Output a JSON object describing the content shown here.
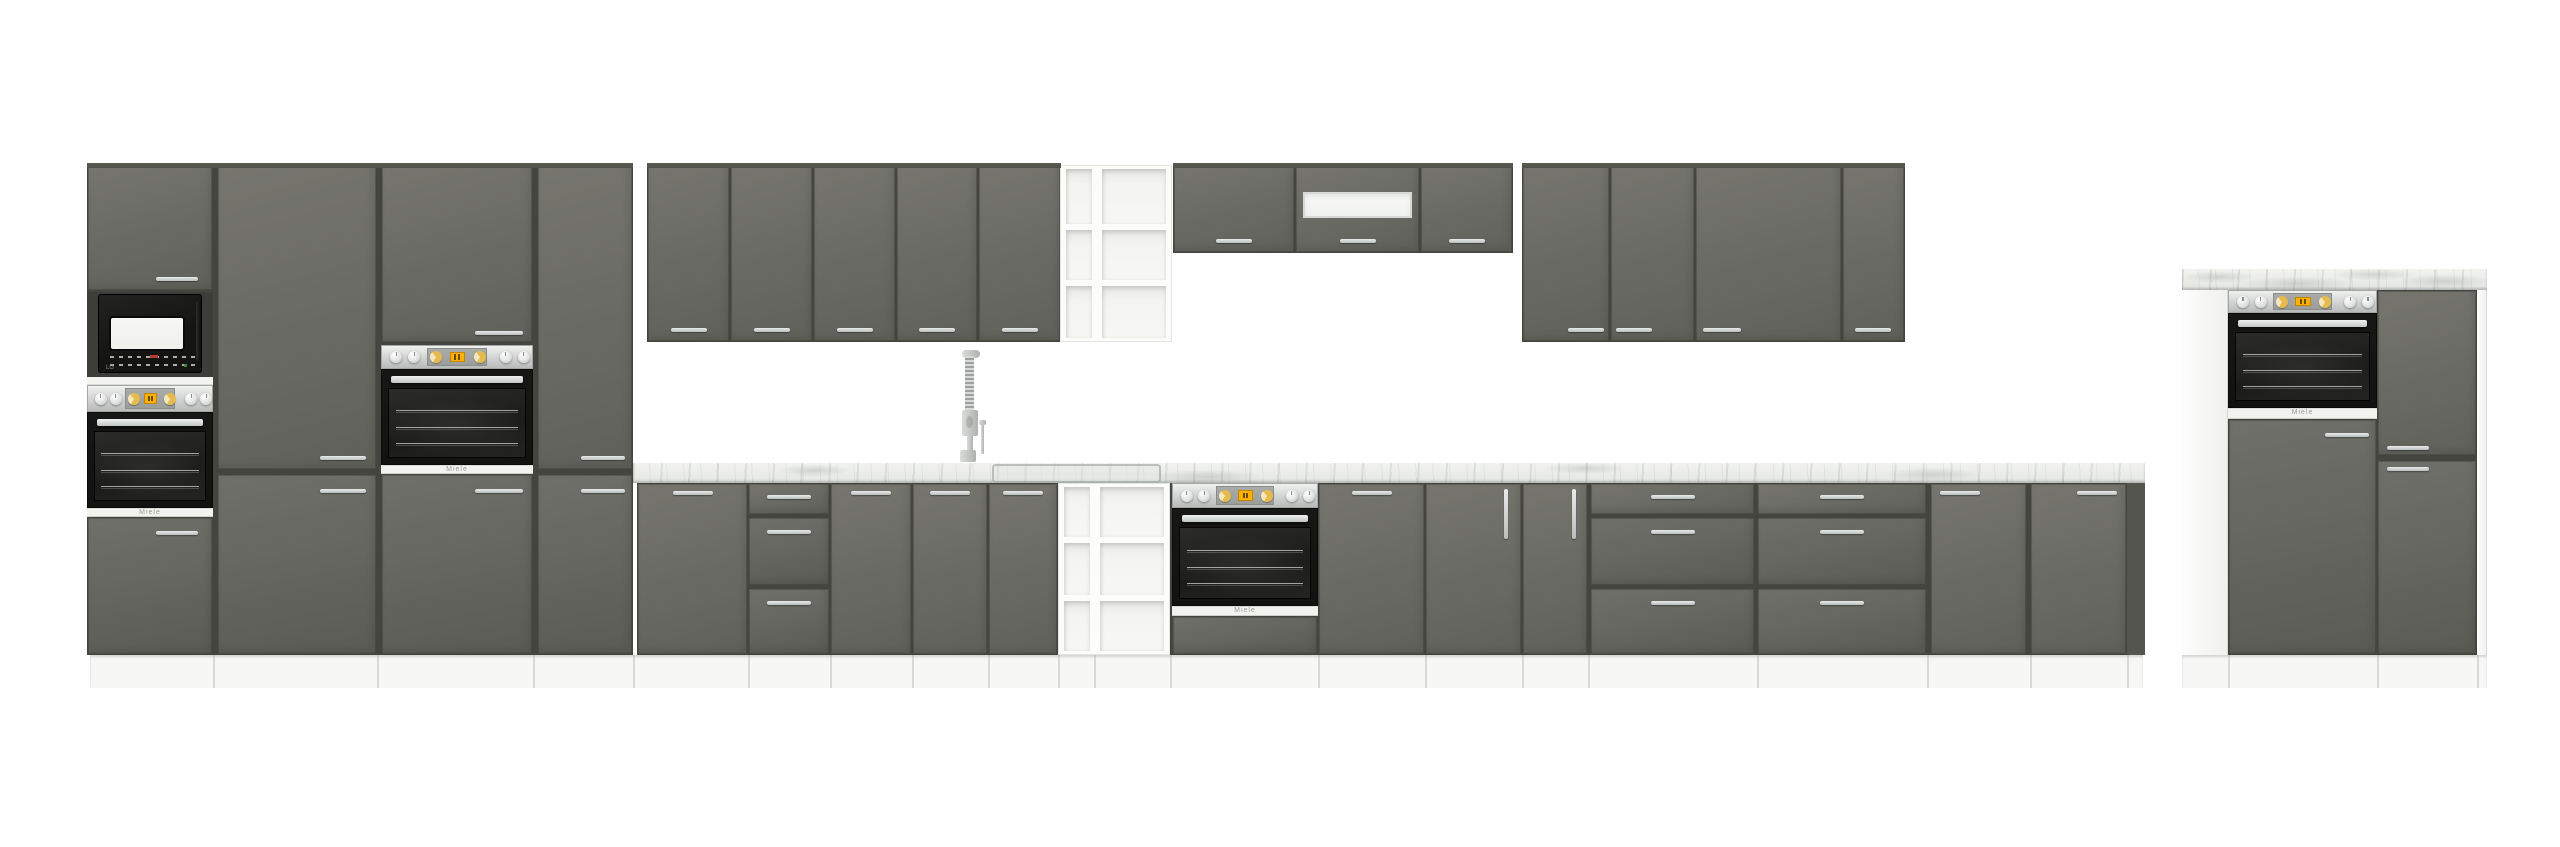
{
  "meta": {
    "description": "Product render of a grey gloss kitchen furniture set on white background",
    "canvas_width": 2560,
    "canvas_height": 847
  },
  "palette": {
    "cabinet_grey": "#6c6c66",
    "cabinet_grey_dark": "#5b5b56",
    "carcass_dark": "#45453f",
    "handle_silver": "#c9cdcc",
    "worktop_marble": "#e9ebe7",
    "appliance_black": "#141413",
    "panel_silver": "#d9dcda",
    "knob_gold": "#e5ba4e",
    "display_amber": "#ffb103",
    "white": "#ffffff"
  },
  "branding": {
    "oven_logo": "Miele",
    "microwave_logo": "LG"
  },
  "scene": {
    "units": [
      {
        "t": "backing",
        "n": "tall-cabinet-group-carcass",
        "x": 87,
        "y": 163,
        "w": 546,
        "h": 492
      },
      {
        "t": "backing",
        "n": "wall-cabinet-run-a-carcass",
        "x": 647,
        "y": 163,
        "w": 414,
        "h": 179
      },
      {
        "t": "backing",
        "n": "wall-cabinet-run-b-carcass",
        "x": 1173,
        "y": 163,
        "w": 340,
        "h": 90
      },
      {
        "t": "backing",
        "n": "wall-cabinet-run-c-carcass",
        "x": 1522,
        "y": 163,
        "w": 383,
        "h": 179
      },
      {
        "t": "backing",
        "n": "base-run-carcass",
        "x": 637,
        "y": 483,
        "w": 1508,
        "h": 172
      },
      {
        "t": "backing",
        "n": "right-group-carcass",
        "x": 2228,
        "y": 290,
        "w": 249,
        "h": 365
      },
      {
        "t": "door",
        "n": "tall-unit-top-door",
        "x": 87,
        "y": 163,
        "w": 126,
        "h": 128,
        "hx": 156,
        "hy": 277,
        "hw": 42
      },
      {
        "t": "micro",
        "n": "built-in-microwave",
        "x": 87,
        "y": 292,
        "w": 126,
        "h": 85
      },
      {
        "t": "whitestrip",
        "n": "shelf-strip",
        "x": 87,
        "y": 377,
        "w": 126,
        "h": 8
      },
      {
        "t": "opanel",
        "n": "oven-control-panel",
        "x": 87,
        "y": 385,
        "w": 126,
        "h": 27
      },
      {
        "t": "oven",
        "n": "built-in-oven",
        "x": 87,
        "y": 412,
        "w": 126,
        "h": 96
      },
      {
        "t": "logostrip",
        "n": "oven-logo-strip",
        "x": 87,
        "y": 508,
        "w": 126,
        "h": 9,
        "label": "oven_logo"
      },
      {
        "t": "door",
        "n": "tall-unit-bottom-door",
        "x": 87,
        "y": 517,
        "w": 126,
        "h": 138,
        "hx": 156,
        "hy": 531,
        "hw": 42,
        "dk": 1
      },
      {
        "t": "door",
        "n": "pantry-tall-door",
        "x": 217,
        "y": 163,
        "w": 160,
        "h": 307,
        "hx": 320,
        "hy": 456,
        "hw": 46
      },
      {
        "t": "door",
        "n": "pantry-bottom-door",
        "x": 217,
        "y": 474,
        "w": 160,
        "h": 181,
        "hx": 320,
        "hy": 489,
        "hw": 46,
        "dk": 1
      },
      {
        "t": "door",
        "n": "oven-tower-top-door",
        "x": 381,
        "y": 163,
        "w": 152,
        "h": 180,
        "hx": 475,
        "hy": 331,
        "hw": 48
      },
      {
        "t": "opanel",
        "n": "oven-control-panel",
        "x": 381,
        "y": 345,
        "w": 152,
        "h": 24
      },
      {
        "t": "oven",
        "n": "built-in-oven",
        "x": 381,
        "y": 369,
        "w": 152,
        "h": 96
      },
      {
        "t": "logostrip",
        "n": "oven-logo-strip",
        "x": 381,
        "y": 465,
        "w": 152,
        "h": 9,
        "label": "oven_logo"
      },
      {
        "t": "door",
        "n": "oven-tower-bottom-door",
        "x": 381,
        "y": 474,
        "w": 152,
        "h": 181,
        "hx": 475,
        "hy": 489,
        "hw": 48,
        "dk": 1
      },
      {
        "t": "door",
        "n": "tall-unit-door",
        "x": 537,
        "y": 163,
        "w": 96,
        "h": 307,
        "hx": 581,
        "hy": 456,
        "hw": 44
      },
      {
        "t": "door",
        "n": "tall-unit-bottom-door",
        "x": 537,
        "y": 474,
        "w": 96,
        "h": 181,
        "hx": 581,
        "hy": 489,
        "hw": 44,
        "dk": 1
      },
      {
        "t": "door",
        "n": "wall-cabinet-door",
        "x": 647,
        "y": 163,
        "w": 83,
        "h": 179,
        "hc": 1,
        "hy": 328,
        "hw": 36
      },
      {
        "t": "door",
        "n": "wall-cabinet-door",
        "x": 730,
        "y": 163,
        "w": 83,
        "h": 179,
        "hc": 1,
        "hy": 328,
        "hw": 36
      },
      {
        "t": "door",
        "n": "wall-cabinet-door",
        "x": 813,
        "y": 163,
        "w": 83,
        "h": 179,
        "hc": 1,
        "hy": 328,
        "hw": 36
      },
      {
        "t": "door",
        "n": "wall-cabinet-door",
        "x": 896,
        "y": 163,
        "w": 82,
        "h": 179,
        "hc": 1,
        "hy": 328,
        "hw": 36
      },
      {
        "t": "door",
        "n": "wall-cabinet-door",
        "x": 978,
        "y": 163,
        "w": 83,
        "h": 179,
        "hc": 1,
        "hy": 328,
        "hw": 36
      },
      {
        "t": "shelf",
        "n": "open-shelf-wall-unit",
        "x": 1060,
        "y": 165,
        "w": 112,
        "h": 177,
        "cols": [
          [
            1066,
            26
          ],
          [
            1102,
            64
          ]
        ],
        "rowsplits": [
          227,
          283
        ]
      },
      {
        "t": "door",
        "n": "wall-cabinet-door",
        "x": 1173,
        "y": 163,
        "w": 122,
        "h": 90,
        "hc": 1,
        "hy": 239,
        "hw": 36
      },
      {
        "t": "door",
        "n": "hood-cabinet-door",
        "x": 1295,
        "y": 163,
        "w": 125,
        "h": 90,
        "hc": 1,
        "hy": 239,
        "hw": 36,
        "glass": [
          1303,
          192,
          109,
          26
        ]
      },
      {
        "t": "door",
        "n": "wall-cabinet-door",
        "x": 1420,
        "y": 163,
        "w": 93,
        "h": 90,
        "hc": 1,
        "hy": 239,
        "hw": 36
      },
      {
        "t": "door",
        "n": "wall-cabinet-door",
        "x": 1522,
        "y": 163,
        "w": 88,
        "h": 179,
        "hx": 1568,
        "hy": 328,
        "hw": 36
      },
      {
        "t": "door",
        "n": "wall-cabinet-door",
        "x": 1610,
        "y": 163,
        "w": 85,
        "h": 179,
        "hx": 1616,
        "hy": 328,
        "hw": 36
      },
      {
        "t": "door",
        "n": "wall-cabinet-door",
        "x": 1695,
        "y": 163,
        "w": 147,
        "h": 179,
        "hx": 1703,
        "hy": 328,
        "hw": 38
      },
      {
        "t": "door",
        "n": "wall-cabinet-door",
        "x": 1842,
        "y": 163,
        "w": 63,
        "h": 179,
        "hx": 1855,
        "hy": 328,
        "hw": 36
      },
      {
        "t": "marble",
        "n": "worktop",
        "x": 633,
        "y": 462,
        "w": 1512,
        "h": 21
      },
      {
        "t": "door",
        "n": "base-cabinet-door",
        "x": 637,
        "y": 483,
        "w": 111,
        "h": 172,
        "hc": 1,
        "hy": 491,
        "hw": 40
      },
      {
        "t": "drawers",
        "n": "drawer-unit",
        "x": 748,
        "y": 483,
        "w": 82,
        "hw": 44
      },
      {
        "t": "door",
        "n": "base-cabinet-door",
        "x": 830,
        "y": 483,
        "w": 82,
        "h": 172,
        "hc": 1,
        "hy": 491,
        "hw": 40
      },
      {
        "t": "door",
        "n": "base-cabinet-door",
        "x": 912,
        "y": 483,
        "w": 76,
        "h": 172,
        "hc": 1,
        "hy": 491,
        "hw": 40
      },
      {
        "t": "door",
        "n": "base-cabinet-door",
        "x": 988,
        "y": 483,
        "w": 70,
        "h": 172,
        "hc": 1,
        "hy": 491,
        "hw": 40
      },
      {
        "t": "shelf",
        "n": "open-shelf-base-unit",
        "x": 1058,
        "y": 483,
        "w": 112,
        "h": 172,
        "cols": [
          [
            1064,
            26
          ],
          [
            1100,
            64
          ]
        ],
        "rowsplits": [
          540,
          598
        ]
      },
      {
        "t": "opanel",
        "n": "oven-control-panel",
        "x": 1172,
        "y": 483,
        "w": 146,
        "h": 25
      },
      {
        "t": "oven",
        "n": "built-in-oven",
        "x": 1172,
        "y": 508,
        "w": 146,
        "h": 98
      },
      {
        "t": "logostrip",
        "n": "oven-logo-strip",
        "x": 1172,
        "y": 606,
        "w": 146,
        "h": 10,
        "label": "oven_logo"
      },
      {
        "t": "door",
        "n": "oven-base-filler-panel",
        "x": 1172,
        "y": 616,
        "w": 146,
        "h": 39,
        "dk": 1
      },
      {
        "t": "door",
        "n": "base-cabinet-door",
        "x": 1318,
        "y": 483,
        "w": 107,
        "h": 172,
        "hc": 1,
        "hy": 491,
        "hw": 40
      },
      {
        "t": "door",
        "n": "base-cabinet-door",
        "x": 1425,
        "y": 483,
        "w": 97,
        "h": 172,
        "hv": 1,
        "hx": 1504,
        "hy": 489,
        "hh": 50
      },
      {
        "t": "door",
        "n": "base-cabinet-door",
        "x": 1522,
        "y": 483,
        "w": 66,
        "h": 172,
        "hv": 1,
        "hx": 1572,
        "hy": 489,
        "hh": 50
      },
      {
        "t": "drawers",
        "n": "drawer-unit",
        "x": 1590,
        "y": 483,
        "w": 165,
        "hw": 44
      },
      {
        "t": "drawers",
        "n": "drawer-unit",
        "x": 1757,
        "y": 483,
        "w": 170,
        "hw": 44
      },
      {
        "t": "door",
        "n": "base-cabinet-door",
        "x": 1930,
        "y": 483,
        "w": 97,
        "h": 172,
        "hx": 1940,
        "hy": 491,
        "hw": 40
      },
      {
        "t": "door",
        "n": "base-cabinet-door",
        "x": 2030,
        "y": 483,
        "w": 97,
        "h": 172,
        "hx": 2077,
        "hy": 491,
        "hw": 40
      },
      {
        "t": "sliver",
        "n": "base-run-end-panel",
        "x": 2127,
        "y": 483,
        "w": 18,
        "h": 172
      },
      {
        "t": "marble",
        "n": "right-group-worktop",
        "x": 2182,
        "y": 268,
        "w": 305,
        "h": 22
      },
      {
        "t": "whitepanel",
        "n": "right-group-side-panel",
        "x": 2182,
        "y": 290,
        "w": 46,
        "h": 365
      },
      {
        "t": "opanel",
        "n": "oven-control-panel",
        "x": 2228,
        "y": 290,
        "w": 149,
        "h": 23
      },
      {
        "t": "oven",
        "n": "built-in-oven",
        "x": 2228,
        "y": 313,
        "w": 149,
        "h": 95
      },
      {
        "t": "logostrip",
        "n": "oven-logo-strip",
        "x": 2228,
        "y": 408,
        "w": 149,
        "h": 11,
        "label": "oven_logo"
      },
      {
        "t": "door",
        "n": "oven-tower-bottom-door",
        "x": 2228,
        "y": 419,
        "w": 149,
        "h": 236,
        "hx": 2325,
        "hy": 433,
        "hw": 44,
        "dk": 1
      },
      {
        "t": "door",
        "n": "right-unit-top-door",
        "x": 2377,
        "y": 290,
        "w": 100,
        "h": 166,
        "hx": 2387,
        "hy": 446,
        "hw": 42
      },
      {
        "t": "door",
        "n": "right-unit-bottom-door",
        "x": 2377,
        "y": 460,
        "w": 100,
        "h": 195,
        "hx": 2387,
        "hy": 467,
        "hw": 42,
        "dk": 1
      },
      {
        "t": "whitepanel",
        "n": "right-group-end-panel",
        "x": 2477,
        "y": 290,
        "w": 10,
        "h": 365
      },
      {
        "t": "topedge",
        "n": "cabinet-top-edge",
        "x": 87,
        "y": 163,
        "w": 546,
        "h": 5
      },
      {
        "t": "topedge",
        "n": "cabinet-top-edge",
        "x": 647,
        "y": 163,
        "w": 414,
        "h": 5
      },
      {
        "t": "topedge",
        "n": "cabinet-top-edge",
        "x": 1173,
        "y": 163,
        "w": 340,
        "h": 5
      },
      {
        "t": "topedge",
        "n": "cabinet-top-edge",
        "x": 1522,
        "y": 163,
        "w": 383,
        "h": 5
      },
      {
        "t": "plinth",
        "n": "plinth",
        "x": 90,
        "y": 655,
        "w": 2053,
        "h": 33,
        "lines": [
          213,
          377,
          533,
          633,
          748,
          830,
          912,
          988,
          1058,
          1094,
          1170,
          1318,
          1425,
          1522,
          1588,
          1757,
          1927,
          2030,
          2127
        ]
      },
      {
        "t": "plinth",
        "n": "plinth",
        "x": 2182,
        "y": 655,
        "w": 305,
        "h": 33,
        "lines": [
          2228,
          2377,
          2477
        ]
      },
      {
        "t": "sink",
        "n": "sink-outline",
        "x": 992,
        "y": 464,
        "w": 165,
        "h": 15
      },
      {
        "t": "faucet",
        "n": "kitchen-faucet",
        "x": 950,
        "y": 348,
        "w": 45,
        "h": 114
      }
    ]
  }
}
